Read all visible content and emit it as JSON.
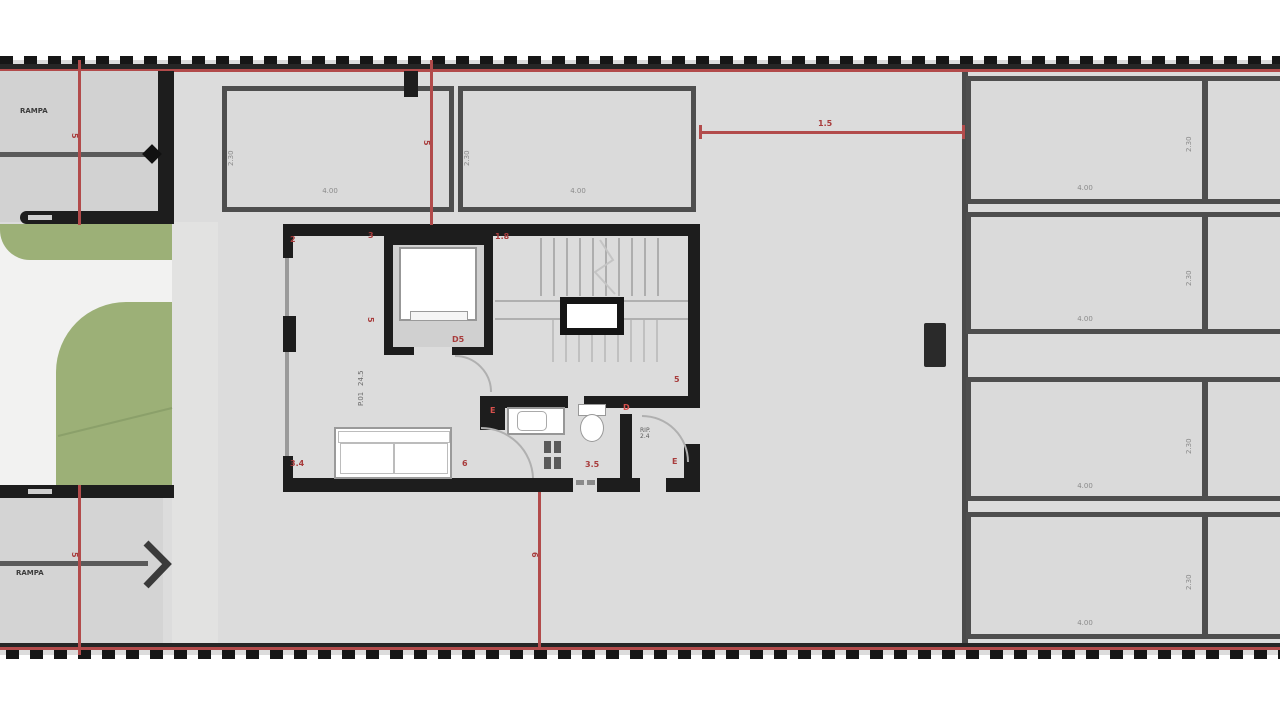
{
  "plan": {
    "type": "garage-floor-plan",
    "colors": {
      "floor": "#dcdcdc",
      "floor_dark": "#d2d2d2",
      "wall": "#1d1d1d",
      "stall_border": "#4e4e4e",
      "garden_green": "#9cb077",
      "path_white": "#f2f2f1",
      "dimension_red": "#a83c3c",
      "boundary_red": "#b24b4b"
    },
    "labels": {
      "ramp_top": "RAMPA",
      "ramp_bottom": "RAMPA",
      "room_name": "P.01",
      "room_area": "24.5",
      "storage_name": "RIP.",
      "storage_area": "2.4"
    },
    "dimensions": {
      "top_span": "1.5",
      "left_line_top": "5",
      "left_line_bottom": "5",
      "center_line_top": "5",
      "center_line_bottom": "6",
      "apt_corner_left": "2",
      "apt_corner_mid": "3",
      "apt_corner_right": "1.8",
      "apt_left_mid": "5",
      "elevator": "D5",
      "apt_bottom_left": "3.4",
      "apt_bottom_mid": "6",
      "bath_top": "E",
      "bath_bottom": "3.5",
      "storage_top": "D",
      "storage_bottom": "E",
      "stair_bottom": "5"
    },
    "stalls": {
      "top": [
        {
          "length": "4.00",
          "depth": "2.30"
        },
        {
          "length": "4.00",
          "depth": "2.30"
        }
      ],
      "right": [
        {
          "length": "4.00",
          "depth": "2.30"
        },
        {
          "length": "4.00",
          "depth": "2.30"
        },
        {
          "length": "4.00",
          "depth": "2.30"
        },
        {
          "length": "4.00",
          "depth": "2.30"
        }
      ]
    }
  }
}
